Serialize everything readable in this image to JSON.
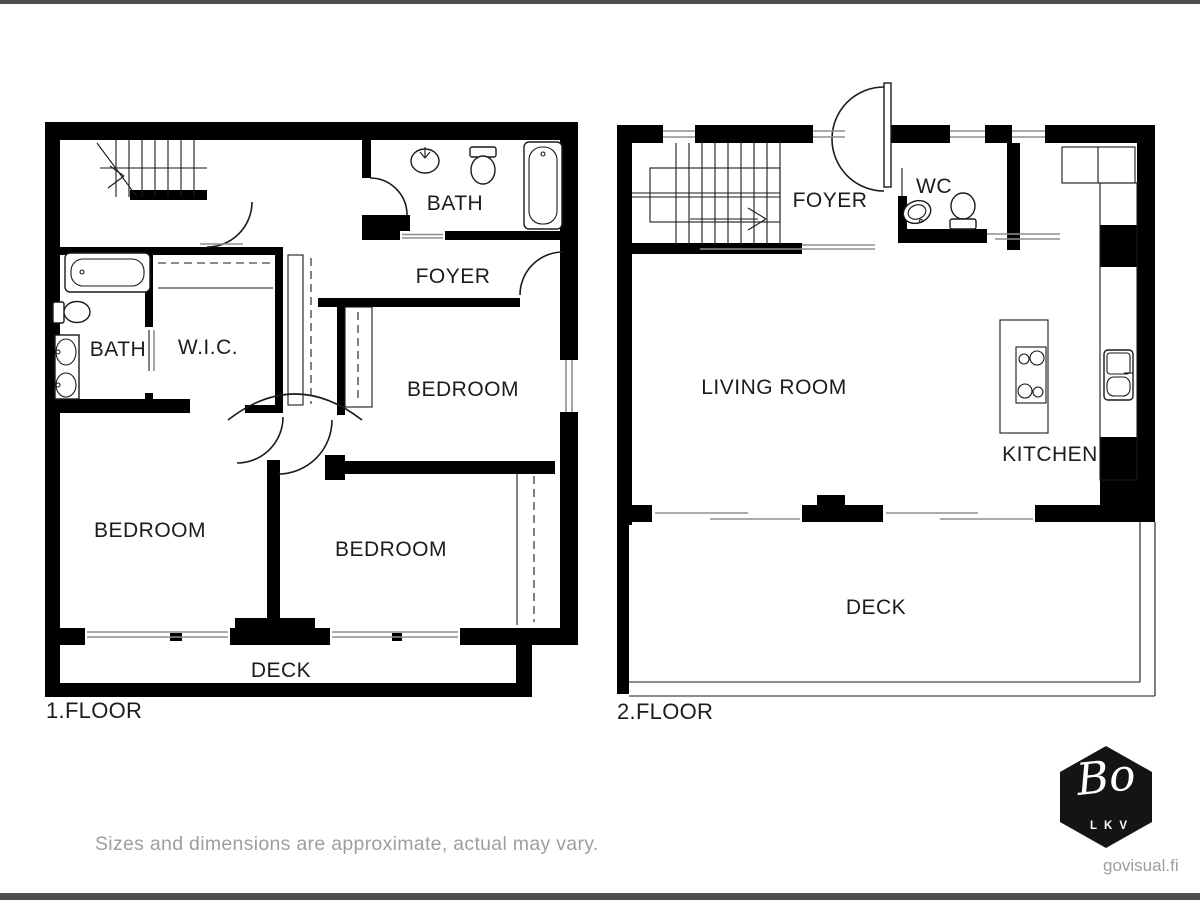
{
  "colors": {
    "wall": "#000000",
    "line": "#1a1a1a",
    "winline": "#8f8f8f",
    "label": "#1c1c1c",
    "muted": "#9e9e9e",
    "bar": "#4f4f4f",
    "logo-bg": "#141414",
    "logo-fg": "#ffffff",
    "paper": "#ffffff"
  },
  "floor1": {
    "label": "1.FLOOR",
    "rooms": {
      "bath_top": {
        "label": "BATH"
      },
      "foyer": {
        "label": "FOYER"
      },
      "bath_left": {
        "label": "BATH"
      },
      "wic": {
        "label": "W.I.C."
      },
      "bedroom_right": {
        "label": "BEDROOM"
      },
      "bedroom_left": {
        "label": "BEDROOM"
      },
      "bedroom_middle": {
        "label": "BEDROOM"
      },
      "deck": {
        "label": "DECK"
      }
    }
  },
  "floor2": {
    "label": "2.FLOOR",
    "rooms": {
      "foyer": {
        "label": "FOYER"
      },
      "wc": {
        "label": "WC"
      },
      "living_room": {
        "label": "LIVING ROOM"
      },
      "kitchen": {
        "label": "KITCHEN"
      },
      "deck": {
        "label": "DECK"
      }
    }
  },
  "footer": {
    "disclaimer": "Sizes and dimensions are approximate, actual may vary."
  },
  "branding": {
    "logo_text": "Bo",
    "logo_subtext": "LKV",
    "website": "govisual.fi"
  }
}
